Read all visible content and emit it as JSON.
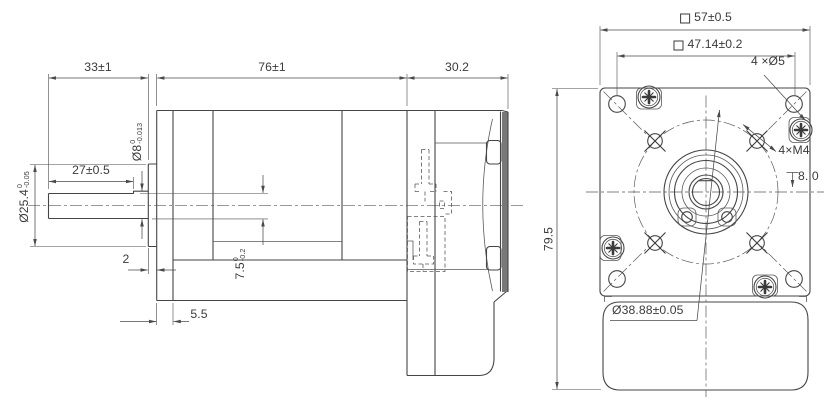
{
  "drawing": {
    "type": "engineering-drawing",
    "line_color": "#454545",
    "background": "#ffffff",
    "side_view": {
      "dim_front_length": "33±1",
      "dim_body_length": "76±1",
      "dim_rear_length": "30.2",
      "dim_flat_length": "27±0.5",
      "shaft_dia": {
        "main": "Ø8",
        "tol_upper": "0",
        "tol_lower": "-0.013"
      },
      "boss_dia": {
        "main": "Ø25.4",
        "tol_upper": "0",
        "tol_lower": "-0.05"
      },
      "flat_height": {
        "main": "7.5",
        "tol_upper": "0",
        "tol_lower": "-0.2"
      },
      "dim_boss_protrusion": "2",
      "dim_flange_thickness": "5.5"
    },
    "front_view": {
      "dim_square": "57±0.5",
      "dim_hole_pitch": "47.14±0.2",
      "label_corner_holes": "4 ×Ø5",
      "label_tapped_holes": "4×M4",
      "tap_depth": "8. 0",
      "dim_overall_height": "79.5",
      "dim_bolt_circle": "Ø38.88±0.05"
    }
  }
}
